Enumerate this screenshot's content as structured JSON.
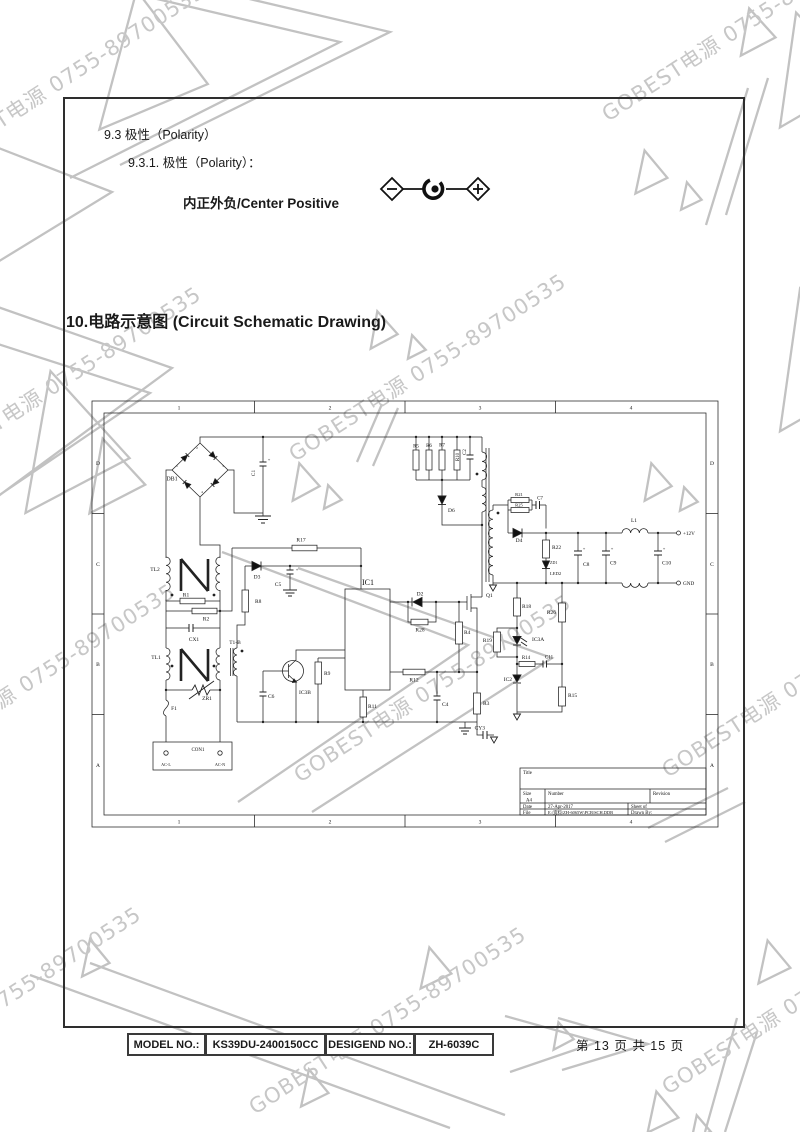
{
  "watermark": {
    "text": "GOBEST电源 0755-89700535",
    "color": "#c7c7c7",
    "triangle_color": "#c2c2c2"
  },
  "sections": {
    "s93": "9.3  极性（Polarity）",
    "s931": "9.3.1.   极性（Polarity）：",
    "polarity_label": "内正外负/Center Positive",
    "s10": "10.电路示意图 (Circuit Schematic Drawing)"
  },
  "schematic": {
    "frame_cols": [
      "1",
      "2",
      "3",
      "4"
    ],
    "frame_rows": [
      "D",
      "C",
      "B",
      "A"
    ],
    "bridge_pins": [
      "1",
      "2",
      "3",
      "4"
    ],
    "refs": {
      "db1": "DB1",
      "c1": "C1",
      "tl2": "TL2",
      "r1": "R1",
      "r2": "R2",
      "cx1": "CX1",
      "tl1": "TL1",
      "zr1": "ZR1",
      "f1": "F1",
      "con1": "CON1",
      "acl": "AC-L",
      "acn": "AC-N",
      "r17": "R17",
      "d3": "D3",
      "c5": "C5",
      "r8": "R8",
      "t1b": "T1-B",
      "ic3b": "IC3B",
      "c6": "C6",
      "r9": "R9",
      "r11": "R11",
      "ic1": "IC1",
      "d2": "D2",
      "r28": "R28",
      "r4": "R4",
      "r12": "R12",
      "c4": "C4",
      "r3": "R3",
      "q1": "Q1",
      "cy3": "CY3",
      "r5": "R5",
      "r6": "R6",
      "r7": "R7",
      "r10": "R10",
      "c2": "C2",
      "d6": "D6",
      "r21": "R21",
      "r25": "R25",
      "c7": "C7",
      "d4": "D4",
      "r22": "R22",
      "zd1": "ZD1",
      "led2": "LED2",
      "c8": "C8",
      "c9": "C9",
      "l1": "L1",
      "c10": "C10",
      "r18": "R18",
      "r19": "R19",
      "ic3a": "IC3A",
      "r14": "R14",
      "c11": "C11",
      "ic2": "IC2",
      "r15": "R15",
      "r26": "R26",
      "v12": "+12V",
      "gnd": "GND"
    },
    "titleblock": {
      "title_label": "Title",
      "size_label": "Size",
      "size_value": "A4",
      "number_label": "Number",
      "revision_label": "Revision",
      "date_label": "Date",
      "date_value": "27-Apr-2017",
      "sheet_label": "Sheet  of",
      "file_label": "File",
      "file_value": "E:\\资料\\ZH-6065W\\PCB\\SCH.DDB",
      "drawn_label": "Drawn By:"
    }
  },
  "footer": {
    "model_label": "MODEL NO.:",
    "model_value": "KS39DU-2400150CC",
    "design_label": "DESIGEND NO.:",
    "design_value": "ZH-6039C",
    "page_text": "第 13 页 共 15 页"
  }
}
